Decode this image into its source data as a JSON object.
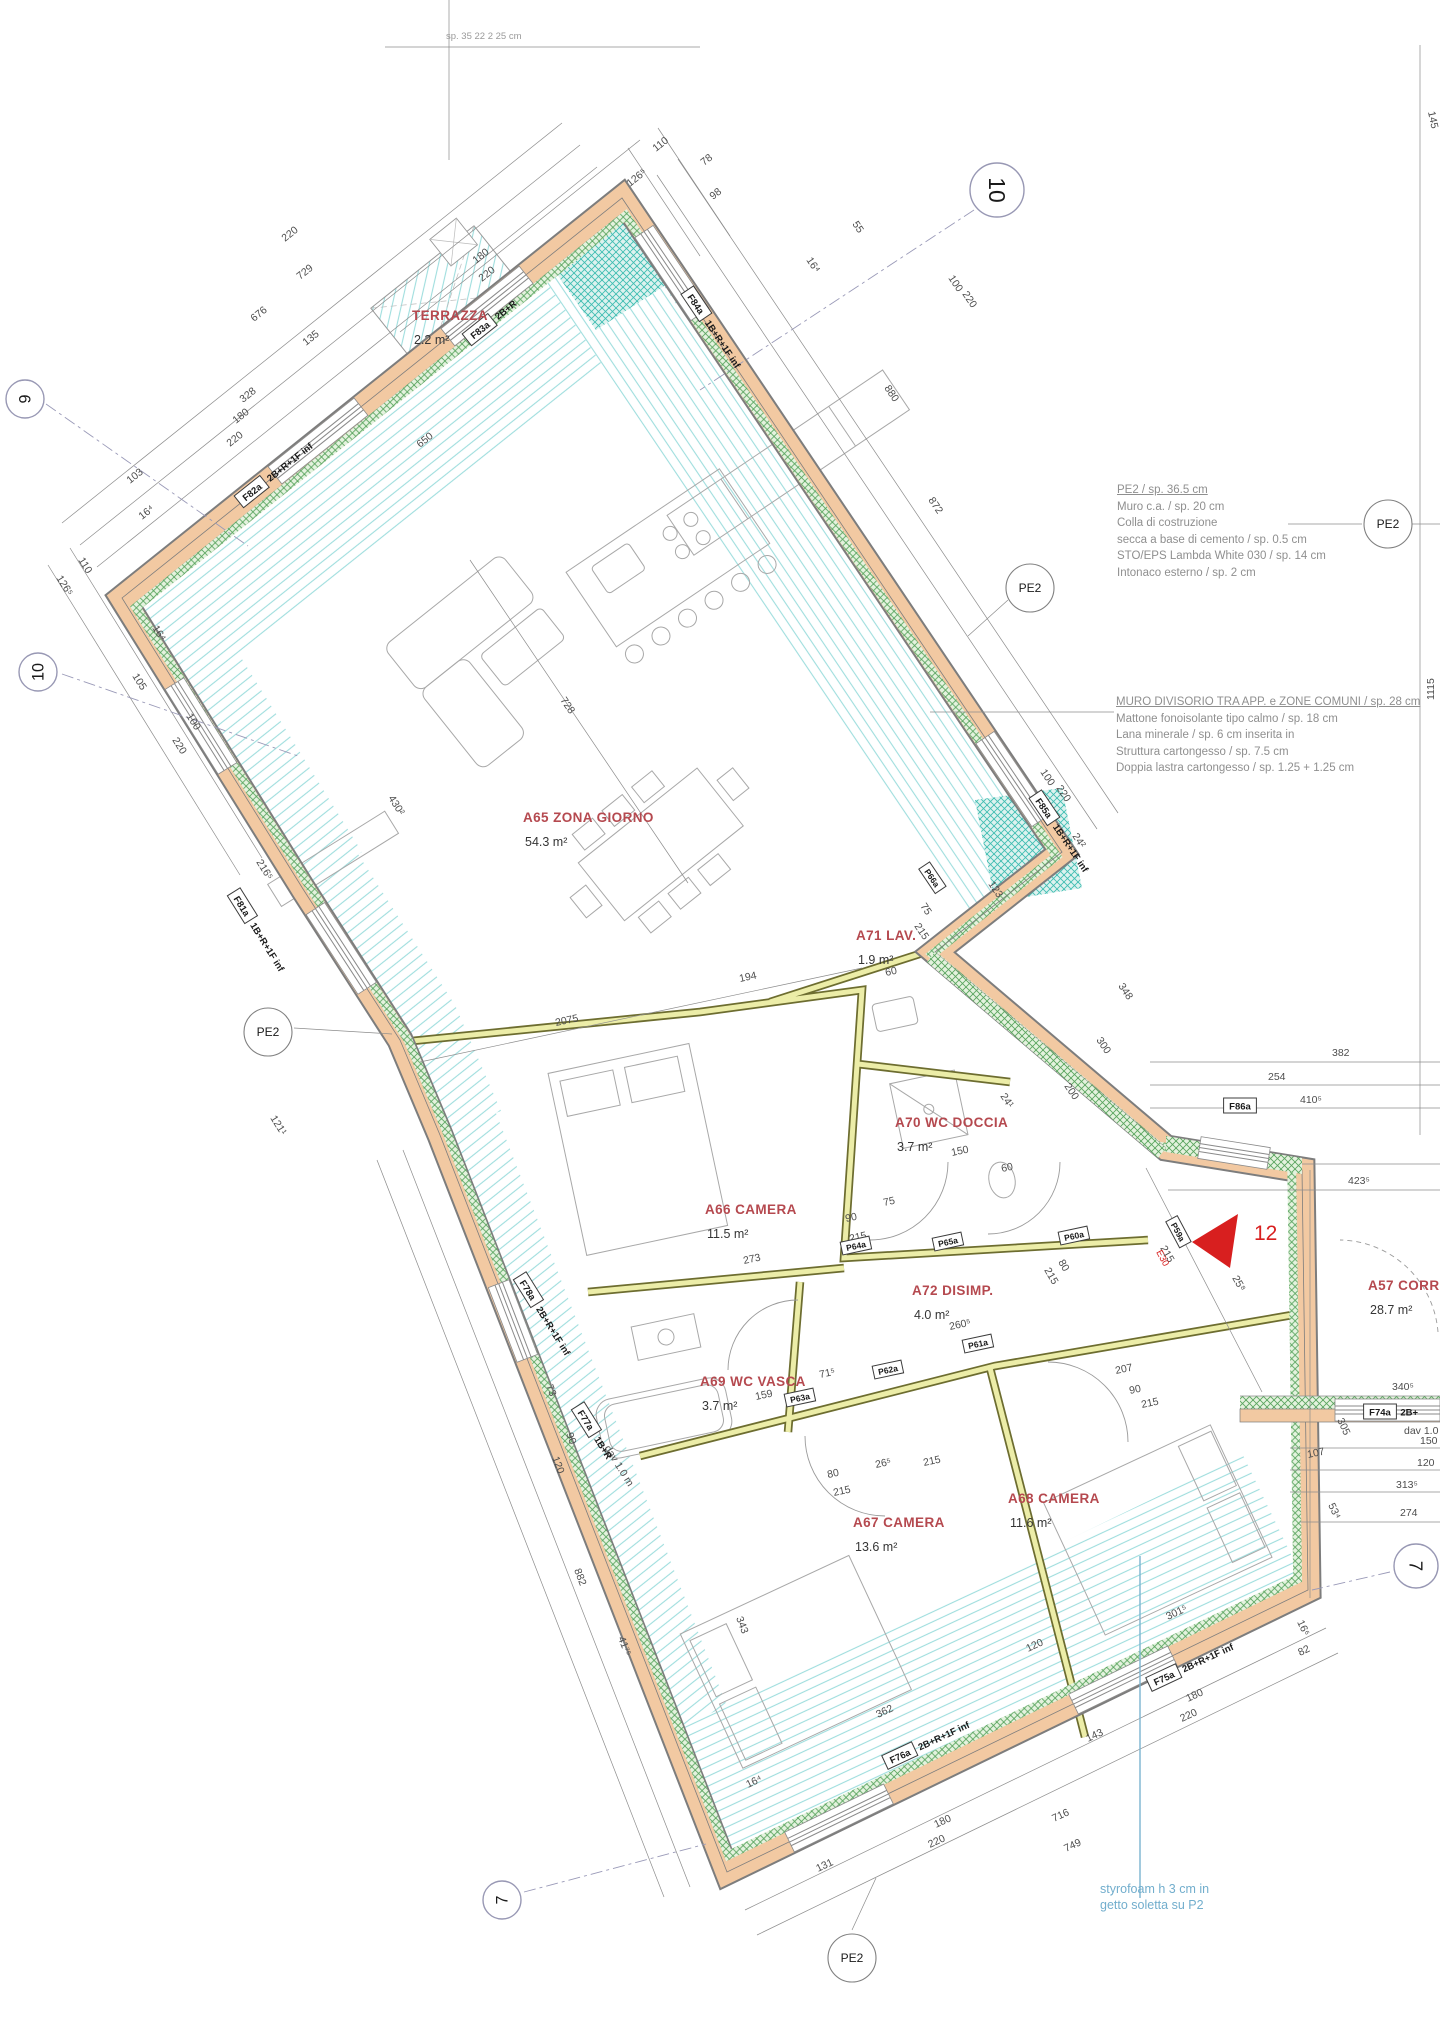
{
  "colors": {
    "wall_fill": "#f2c9a2",
    "insulation_green": "#5aa55f",
    "floor_hatch_cyan": "#9fdede",
    "partition_fill": "#eceda8",
    "room_label_red": "#b5494f",
    "note_gray": "#8f8f8f",
    "note_cyan": "#72aecd",
    "marker_red": "#d81f1f"
  },
  "pe2_label": "PE2",
  "marker": {
    "number": "12",
    "code": "E30"
  },
  "notes": {
    "pe2": {
      "title": "PE2 / sp. 36.5 cm",
      "lines": [
        "Muro c.a. / sp. 20 cm",
        "Colla di costruzione",
        "secca a base di cemento / sp. 0.5 cm",
        "STO/EPS Lambda White 030 / sp. 14 cm",
        "Intonaco esterno / sp. 2 cm"
      ]
    },
    "divisorio": {
      "title": "MURO DIVISORIO TRA APP. e ZONE COMUNI / sp. 28 cm",
      "lines": [
        "Mattone fonoisolante tipo calmo / sp. 18 cm",
        "Lana minerale / sp. 6 cm inserita in",
        "Struttura cartongesso / sp. 7.5 cm",
        "Doppia lastra cartongesso / sp. 1.25 + 1.25 cm"
      ]
    },
    "styrofoam": {
      "lines": [
        "styrofoam h 3 cm in",
        "getto soletta su P2"
      ]
    },
    "top_partial": "sp. 35 22 2 25 cm"
  },
  "rooms": [
    {
      "name": "TERRAZZA",
      "area": "2.2 m²",
      "x": 412,
      "y": 320
    },
    {
      "name": "A65 ZONA GIORNO",
      "area": "54.3 m²",
      "x": 523,
      "y": 822
    },
    {
      "name": "A71 LAV.",
      "area": "1.9 m²",
      "x": 856,
      "y": 940
    },
    {
      "name": "A70 WC DOCCIA",
      "area": "3.7 m²",
      "x": 895,
      "y": 1127
    },
    {
      "name": "A66 CAMERA",
      "area": "11.5 m²",
      "x": 705,
      "y": 1214
    },
    {
      "name": "A72 DISIMP.",
      "area": "4.0 m²",
      "x": 912,
      "y": 1295
    },
    {
      "name": "A69 WC VASCA",
      "area": "3.7 m²",
      "x": 700,
      "y": 1386
    },
    {
      "name": "A67 CAMERA",
      "area": "13.6 m²",
      "x": 853,
      "y": 1527
    },
    {
      "name": "A68 CAMERA",
      "area": "11.6 m²",
      "x": 1008,
      "y": 1503
    },
    {
      "name": "A57 CORRIDOIO",
      "area": "28.7 m²",
      "x": 1368,
      "y": 1290
    }
  ],
  "dims": [
    {
      "t": "729",
      "x": 300,
      "y": 280,
      "r": -38.6
    },
    {
      "t": "676",
      "x": 254,
      "y": 322,
      "r": -38.6
    },
    {
      "t": "220",
      "x": 285,
      "y": 242,
      "r": -38.6
    },
    {
      "t": "135",
      "x": 306,
      "y": 346,
      "r": -38.6
    },
    {
      "t": "328",
      "x": 243,
      "y": 403,
      "r": -38.6
    },
    {
      "t": "180",
      "x": 236,
      "y": 424,
      "r": -38.6
    },
    {
      "t": "220",
      "x": 230,
      "y": 447,
      "r": -38.6
    },
    {
      "t": "103",
      "x": 130,
      "y": 484,
      "r": -38.6
    },
    {
      "t": "16⁴",
      "x": 142,
      "y": 520,
      "r": -38.6
    },
    {
      "t": "180",
      "x": 476,
      "y": 264,
      "r": -38.6
    },
    {
      "t": "220",
      "x": 482,
      "y": 282,
      "r": -38.6
    },
    {
      "t": "110",
      "x": 656,
      "y": 152,
      "r": -38.6
    },
    {
      "t": "126⁵",
      "x": 630,
      "y": 187,
      "r": -38.6
    },
    {
      "t": "78",
      "x": 704,
      "y": 166,
      "r": -38.6
    },
    {
      "t": "98",
      "x": 713,
      "y": 200,
      "r": -38.6
    },
    {
      "t": "55",
      "x": 852,
      "y": 224,
      "r": 56
    },
    {
      "t": "16⁴",
      "x": 806,
      "y": 260,
      "r": 56
    },
    {
      "t": "100",
      "x": 948,
      "y": 278,
      "r": 56
    },
    {
      "t": "220",
      "x": 962,
      "y": 294,
      "r": 56
    },
    {
      "t": "872",
      "x": 928,
      "y": 500,
      "r": 56
    },
    {
      "t": "880",
      "x": 884,
      "y": 388,
      "r": 56
    },
    {
      "t": "100",
      "x": 1040,
      "y": 772,
      "r": 56
    },
    {
      "t": "220",
      "x": 1056,
      "y": 788,
      "r": 56
    },
    {
      "t": "24²",
      "x": 1072,
      "y": 836,
      "r": 56
    },
    {
      "t": "110",
      "x": 78,
      "y": 560,
      "r": 58
    },
    {
      "t": "126⁵",
      "x": 56,
      "y": 578,
      "r": 58
    },
    {
      "t": "16⁴",
      "x": 152,
      "y": 628,
      "r": 58
    },
    {
      "t": "105",
      "x": 132,
      "y": 676,
      "r": 58
    },
    {
      "t": "100",
      "x": 186,
      "y": 716,
      "r": 58
    },
    {
      "t": "220",
      "x": 172,
      "y": 740,
      "r": 58
    },
    {
      "t": "650",
      "x": 420,
      "y": 448,
      "r": -38.6
    },
    {
      "t": "728",
      "x": 560,
      "y": 700,
      "r": 56
    },
    {
      "t": "430²",
      "x": 388,
      "y": 798,
      "r": 58
    },
    {
      "t": "216⁵",
      "x": 256,
      "y": 862,
      "r": 58
    },
    {
      "t": "121¹",
      "x": 270,
      "y": 1118,
      "r": 58
    },
    {
      "t": "2075",
      "x": 556,
      "y": 1026,
      "r": -12
    },
    {
      "t": "194",
      "x": 740,
      "y": 982,
      "r": -12
    },
    {
      "t": "123",
      "x": 988,
      "y": 884,
      "r": 56
    },
    {
      "t": "348",
      "x": 1118,
      "y": 986,
      "r": 56
    },
    {
      "t": "300",
      "x": 1096,
      "y": 1040,
      "r": 56
    },
    {
      "t": "200",
      "x": 1064,
      "y": 1086,
      "r": 56
    },
    {
      "t": "382",
      "x": 1332,
      "y": 1056,
      "r": 0
    },
    {
      "t": "254",
      "x": 1268,
      "y": 1080,
      "r": 0
    },
    {
      "t": "410⁵",
      "x": 1300,
      "y": 1103,
      "r": 0
    },
    {
      "t": "423⁵",
      "x": 1348,
      "y": 1184,
      "r": 0
    },
    {
      "t": "340⁵",
      "x": 1392,
      "y": 1390,
      "r": 0
    },
    {
      "t": "150",
      "x": 1420,
      "y": 1444,
      "r": 0
    },
    {
      "t": "120",
      "x": 1417,
      "y": 1466,
      "r": 0
    },
    {
      "t": "107",
      "x": 1308,
      "y": 1458,
      "r": -12
    },
    {
      "t": "313⁵",
      "x": 1396,
      "y": 1488,
      "r": 0
    },
    {
      "t": "274",
      "x": 1400,
      "y": 1516,
      "r": 0
    },
    {
      "t": "305",
      "x": 1337,
      "y": 1420,
      "r": 65
    },
    {
      "t": "53⁴",
      "x": 1328,
      "y": 1505,
      "r": 65
    },
    {
      "t": "25⁸",
      "x": 1232,
      "y": 1278,
      "r": 60
    },
    {
      "t": "100",
      "x": 1174,
      "y": 1226,
      "r": 60
    },
    {
      "t": "215",
      "x": 1160,
      "y": 1248,
      "r": 60
    },
    {
      "t": "75",
      "x": 920,
      "y": 906,
      "r": 56
    },
    {
      "t": "215",
      "x": 914,
      "y": 926,
      "r": 56
    },
    {
      "t": "60",
      "x": 886,
      "y": 976,
      "r": -12
    },
    {
      "t": "150",
      "x": 952,
      "y": 1156,
      "r": -12
    },
    {
      "t": "60",
      "x": 1002,
      "y": 1172,
      "r": -12
    },
    {
      "t": "24¹",
      "x": 1000,
      "y": 1096,
      "r": 56
    },
    {
      "t": "90",
      "x": 846,
      "y": 1222,
      "r": -12
    },
    {
      "t": "215",
      "x": 850,
      "y": 1242,
      "r": -12
    },
    {
      "t": "75",
      "x": 884,
      "y": 1206,
      "r": -12
    },
    {
      "t": "273",
      "x": 744,
      "y": 1264,
      "r": -12
    },
    {
      "t": "260⁵",
      "x": 950,
      "y": 1330,
      "r": -12
    },
    {
      "t": "80",
      "x": 1058,
      "y": 1262,
      "r": 60
    },
    {
      "t": "215",
      "x": 1044,
      "y": 1270,
      "r": 60
    },
    {
      "t": "159",
      "x": 756,
      "y": 1400,
      "r": -12
    },
    {
      "t": "71⁵",
      "x": 820,
      "y": 1378,
      "r": -12
    },
    {
      "t": "73",
      "x": 546,
      "y": 1386,
      "r": 69
    },
    {
      "t": "90",
      "x": 566,
      "y": 1434,
      "r": 69
    },
    {
      "t": "120",
      "x": 552,
      "y": 1458,
      "r": 69
    },
    {
      "t": "882",
      "x": 574,
      "y": 1570,
      "r": 69
    },
    {
      "t": "41⁷⁵",
      "x": 618,
      "y": 1638,
      "r": 69
    },
    {
      "t": "343",
      "x": 736,
      "y": 1618,
      "r": 69
    },
    {
      "t": "80",
      "x": 828,
      "y": 1478,
      "r": -12
    },
    {
      "t": "215",
      "x": 834,
      "y": 1496,
      "r": -12
    },
    {
      "t": "26⁵",
      "x": 876,
      "y": 1468,
      "r": -12
    },
    {
      "t": "215",
      "x": 924,
      "y": 1466,
      "r": -12
    },
    {
      "t": "207",
      "x": 1116,
      "y": 1374,
      "r": -12
    },
    {
      "t": "90",
      "x": 1130,
      "y": 1394,
      "r": -12
    },
    {
      "t": "215",
      "x": 1142,
      "y": 1408,
      "r": -12
    },
    {
      "t": "362",
      "x": 878,
      "y": 1718,
      "r": -25
    },
    {
      "t": "120",
      "x": 1028,
      "y": 1652,
      "r": -25
    },
    {
      "t": "143",
      "x": 1088,
      "y": 1742,
      "r": -25
    },
    {
      "t": "716",
      "x": 1054,
      "y": 1822,
      "r": -25
    },
    {
      "t": "749",
      "x": 1066,
      "y": 1852,
      "r": -25
    },
    {
      "t": "131",
      "x": 818,
      "y": 1872,
      "r": -25
    },
    {
      "t": "180",
      "x": 936,
      "y": 1828,
      "r": -25
    },
    {
      "t": "220",
      "x": 930,
      "y": 1848,
      "r": -25
    },
    {
      "t": "180",
      "x": 1188,
      "y": 1702,
      "r": -25
    },
    {
      "t": "220",
      "x": 1182,
      "y": 1722,
      "r": -25
    },
    {
      "t": "16⁴",
      "x": 748,
      "y": 1788,
      "r": -25
    },
    {
      "t": "301⁵",
      "x": 1168,
      "y": 1620,
      "r": -25
    },
    {
      "t": "82",
      "x": 1300,
      "y": 1656,
      "r": -25
    },
    {
      "t": "16⁶",
      "x": 1297,
      "y": 1622,
      "r": 65
    },
    {
      "t": "1115",
      "x": 1434,
      "y": 700,
      "r": -90
    },
    {
      "t": "145",
      "x": 1428,
      "y": 112,
      "r": 78
    },
    {
      "t": "dav 1.0 m",
      "x": 604,
      "y": 1448,
      "r": 58
    },
    {
      "t": "dav 1.0 m",
      "x": 1404,
      "y": 1434,
      "r": 0
    }
  ],
  "window_tags": [
    {
      "t": "F82a",
      "sub": "2B+R+1F inf",
      "x": 252,
      "y": 492,
      "r": -38.6
    },
    {
      "t": "F83a",
      "sub": "2B+R",
      "x": 480,
      "y": 330,
      "r": -38.6
    },
    {
      "t": "F84a",
      "sub": "1B+R+1F inf",
      "x": 696,
      "y": 304,
      "r": 56
    },
    {
      "t": "F81a",
      "sub": "1B+R+1F inf",
      "x": 242,
      "y": 906,
      "r": 58
    },
    {
      "t": "F85a",
      "sub": "1B+R+1F inf",
      "x": 1044,
      "y": 808,
      "r": 56
    },
    {
      "t": "F86a",
      "sub": "",
      "x": 1240,
      "y": 1106,
      "r": 0
    },
    {
      "t": "F78a",
      "sub": "2B+R+1F inf",
      "x": 528,
      "y": 1290,
      "r": 58
    },
    {
      "t": "F77a",
      "sub": "1B+R",
      "x": 586,
      "y": 1420,
      "r": 58
    },
    {
      "t": "F76a",
      "sub": "2B+R+1F inf",
      "x": 900,
      "y": 1756,
      "r": -25
    },
    {
      "t": "F75a",
      "sub": "2B+R+1F inf",
      "x": 1164,
      "y": 1678,
      "r": -25
    },
    {
      "t": "F74a",
      "sub": "2B+",
      "x": 1380,
      "y": 1412,
      "r": 0
    }
  ],
  "door_tags": [
    {
      "t": "P64a",
      "x": 856,
      "y": 1246,
      "r": -12
    },
    {
      "t": "P65a",
      "x": 948,
      "y": 1242,
      "r": -12
    },
    {
      "t": "P60a",
      "x": 1074,
      "y": 1236,
      "r": -12
    },
    {
      "t": "P61a",
      "x": 978,
      "y": 1344,
      "r": -12
    },
    {
      "t": "P62a",
      "x": 888,
      "y": 1370,
      "r": -12
    },
    {
      "t": "P63a",
      "x": 800,
      "y": 1398,
      "r": -12
    },
    {
      "t": "P59a",
      "x": 1178,
      "y": 1232,
      "r": 62
    },
    {
      "t": "P66a",
      "x": 932,
      "y": 878,
      "r": 56
    }
  ],
  "bubbles": [
    {
      "t": "10",
      "x": 997,
      "y": 190,
      "r": 90,
      "rad": 27
    },
    {
      "t": "9",
      "x": 25,
      "y": 399,
      "r": -90,
      "rad": 19
    },
    {
      "t": "10",
      "x": 38,
      "y": 672,
      "r": -90,
      "rad": 19
    },
    {
      "t": "7",
      "x": 502,
      "y": 1900,
      "r": -90,
      "rad": 19
    },
    {
      "t": "7",
      "x": 1416,
      "y": 1566,
      "r": 90,
      "rad": 22
    }
  ],
  "pe2_bubbles": [
    {
      "x": 1388,
      "y": 524
    },
    {
      "x": 1030,
      "y": 588
    },
    {
      "x": 268,
      "y": 1032
    },
    {
      "x": 852,
      "y": 1958
    }
  ]
}
